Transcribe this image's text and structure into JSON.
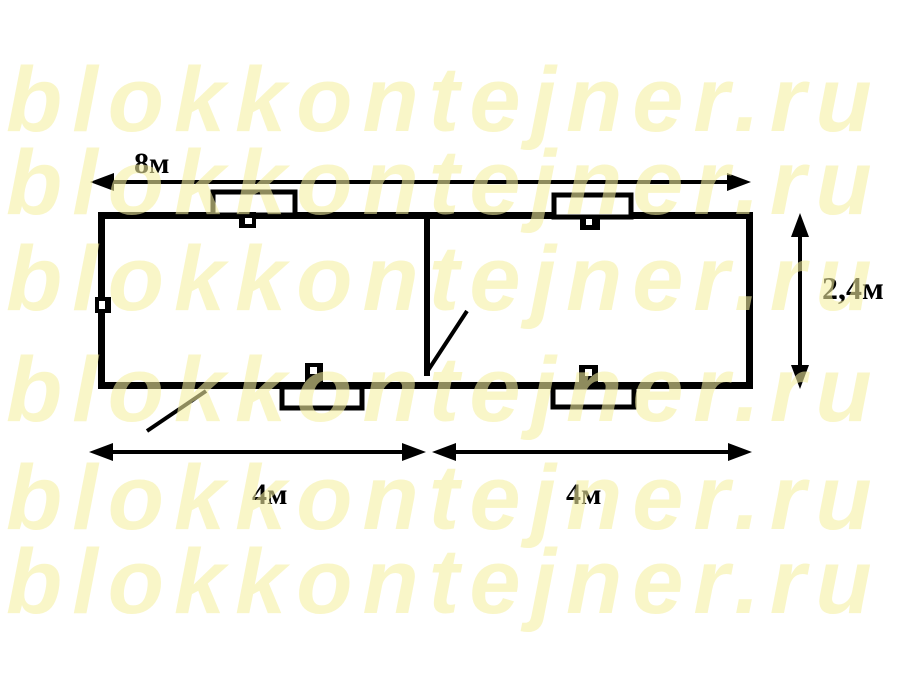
{
  "watermark": {
    "text": "blokkontejner.ru",
    "color": "#F5EFA0",
    "rows": 6
  },
  "plan": {
    "dim_total_width": "8м",
    "dim_height": "2,4м",
    "dim_left_width": "4м",
    "dim_right_width": "4м"
  },
  "colors": {
    "line": "#000000",
    "background": "#FFFFFF",
    "watermark_on_white": "#FAF6C8"
  }
}
